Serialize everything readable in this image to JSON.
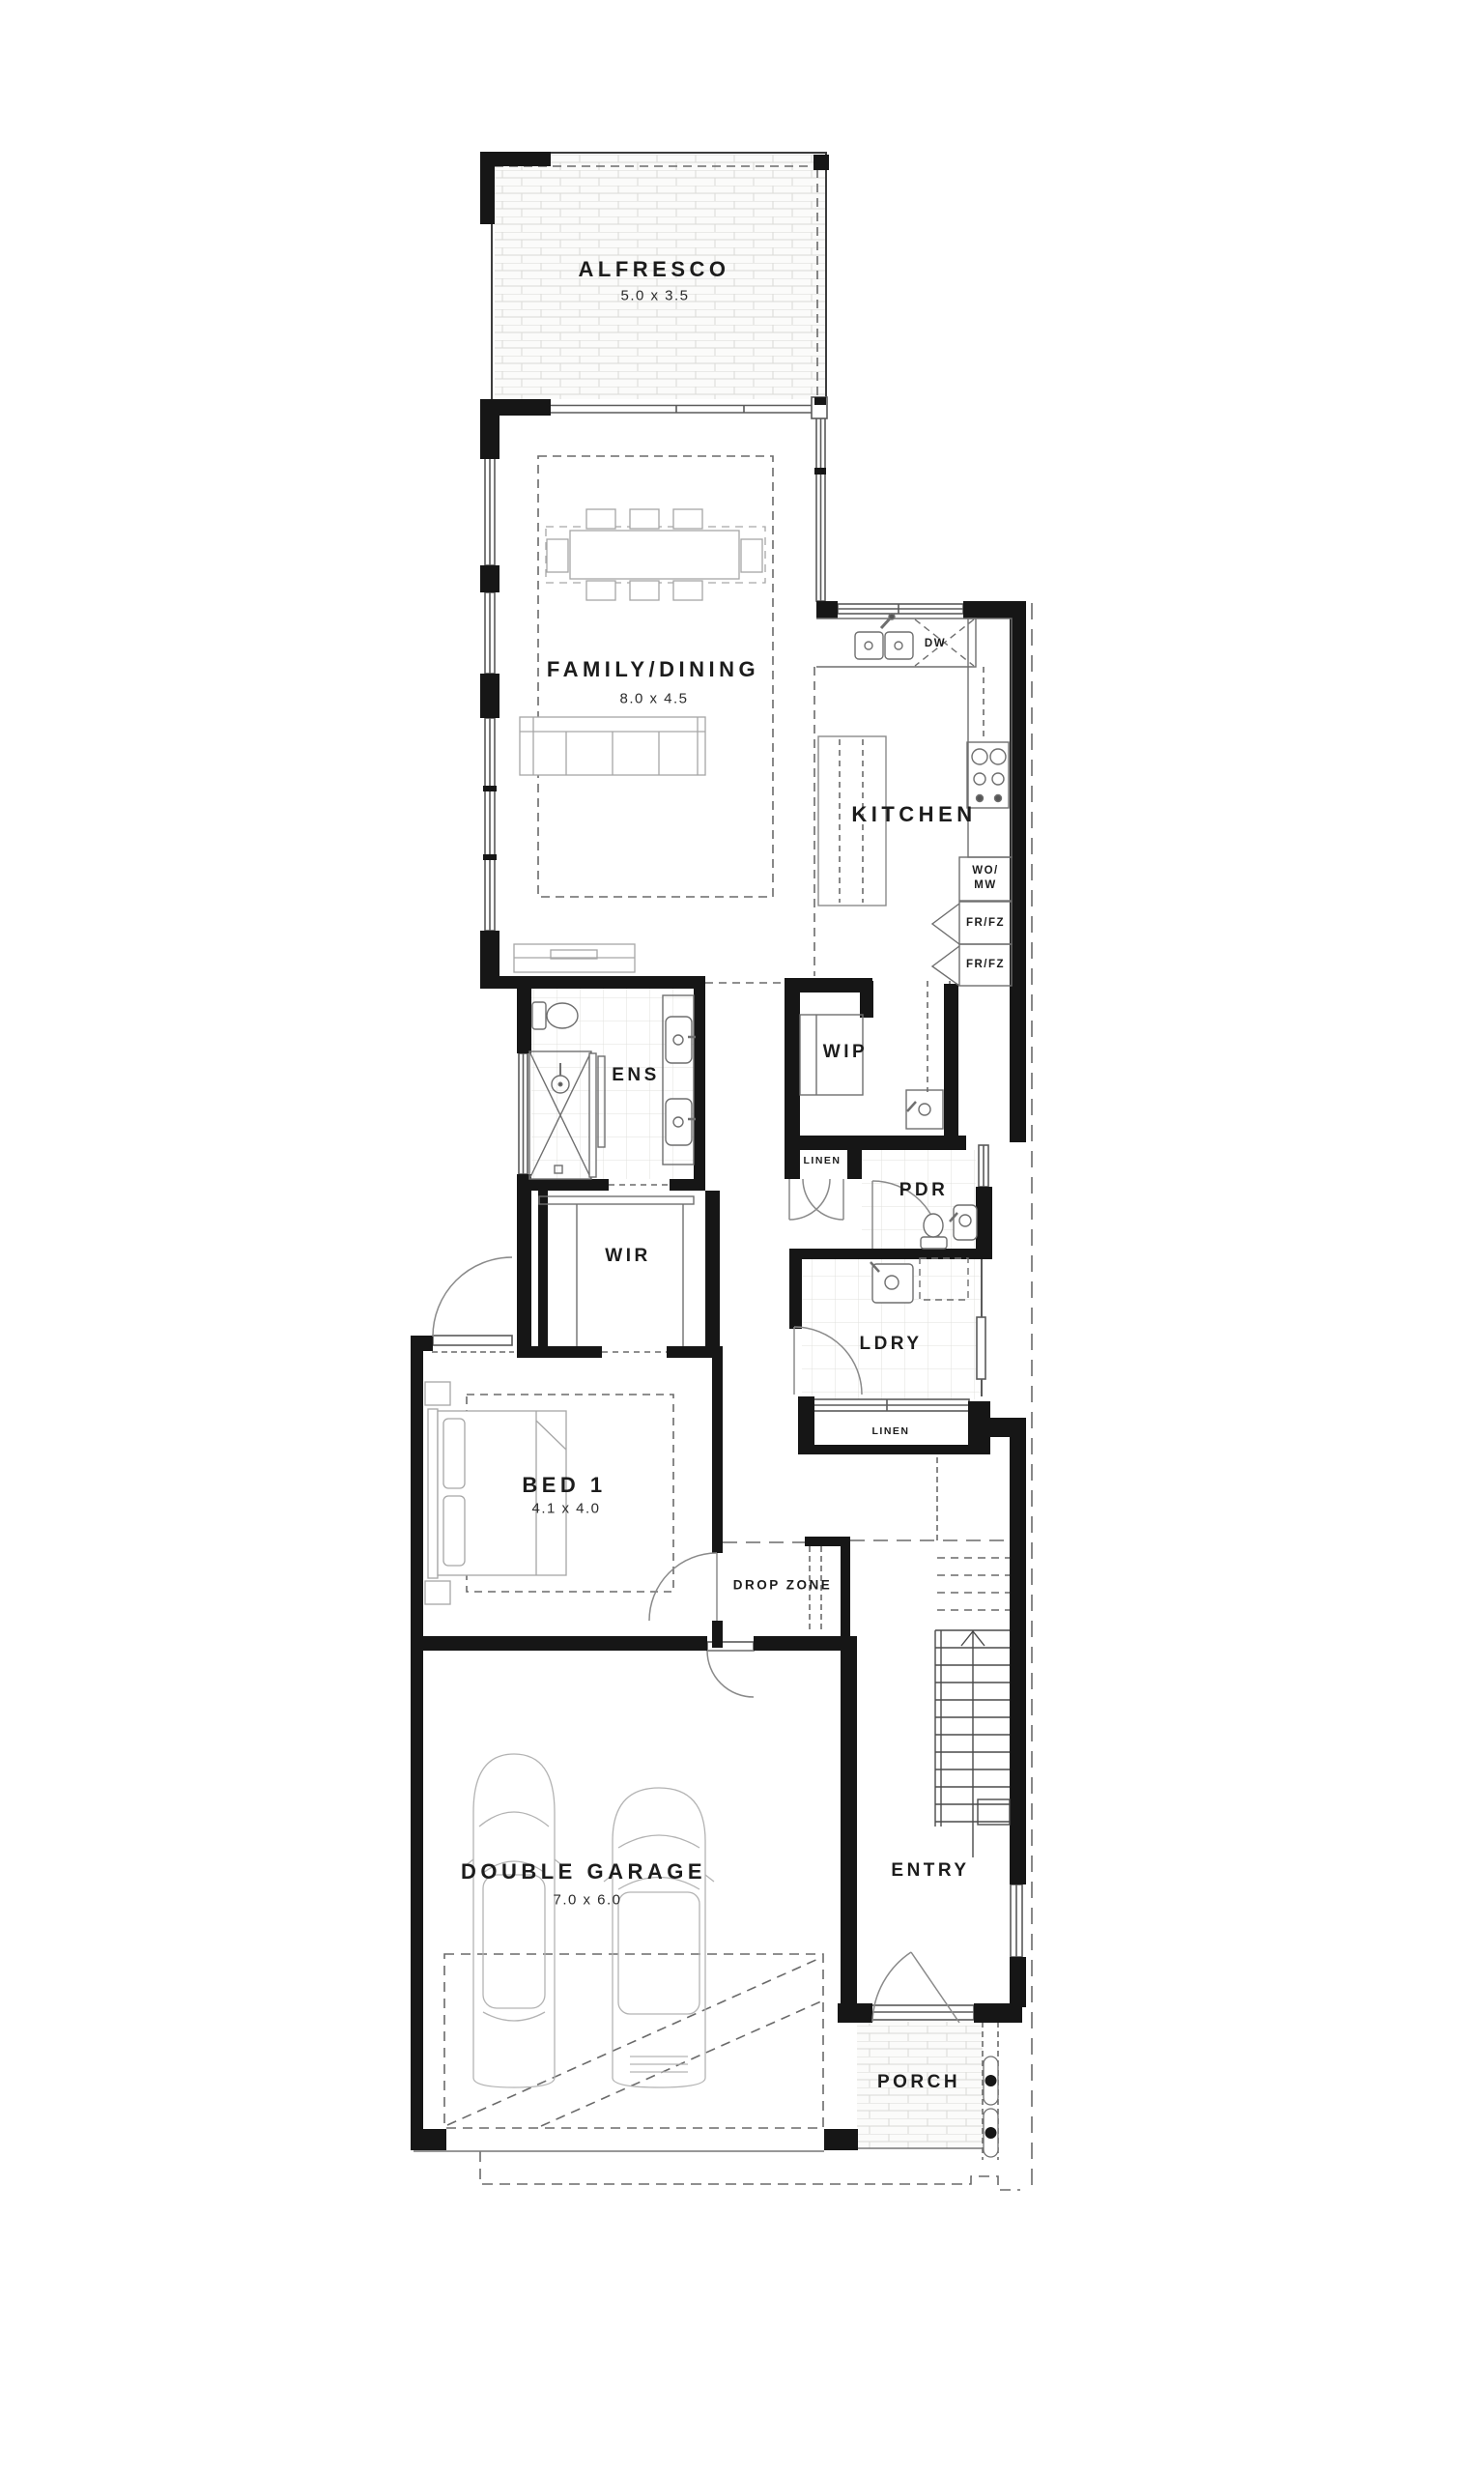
{
  "plan": {
    "rooms": {
      "alfresco": {
        "label": "ALFRESCO",
        "dims": "5.0 x 3.5"
      },
      "family_dining": {
        "label": "FAMILY/DINING",
        "dims": "8.0 x 4.5"
      },
      "kitchen": {
        "label": "KITCHEN"
      },
      "wip": {
        "label": "WIP"
      },
      "ens": {
        "label": "ENS"
      },
      "wir": {
        "label": "WIR"
      },
      "pdr": {
        "label": "PDR"
      },
      "ldry": {
        "label": "LDRY"
      },
      "linen_upper": {
        "label": "LINEN"
      },
      "linen_lower": {
        "label": "LINEN"
      },
      "bed1": {
        "label": "BED 1",
        "dims": "4.1 x 4.0"
      },
      "drop_zone": {
        "label": "DROP ZONE"
      },
      "double_garage": {
        "label": "DOUBLE GARAGE",
        "dims": "7.0 x 6.0"
      },
      "entry": {
        "label": "ENTRY"
      },
      "porch": {
        "label": "PORCH"
      }
    },
    "appliances": {
      "dishwasher": "DW",
      "wall_oven_microwave": "WO/\nMW",
      "fridge_freezer_1": "FR/FZ",
      "fridge_freezer_2": "FR/FZ"
    },
    "colors": {
      "wall": "#161616",
      "line": "#4a4a4a",
      "furniture_line": "#999999",
      "background": "#ffffff"
    }
  }
}
